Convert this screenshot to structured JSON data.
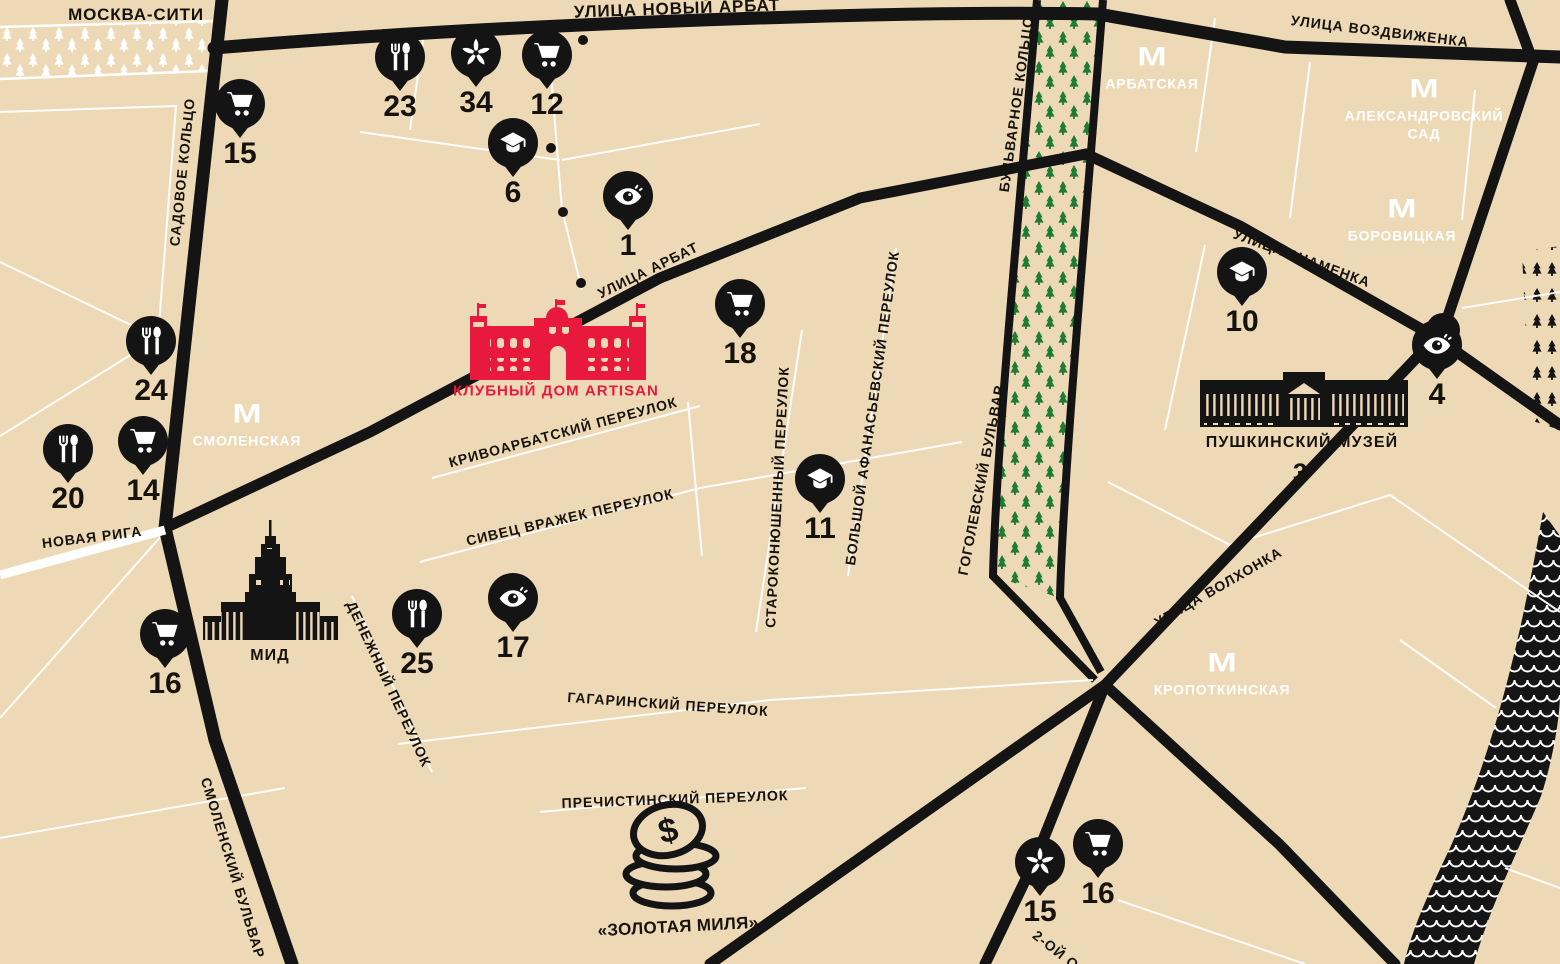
{
  "streets": {
    "moskva_city": "МОСКВА-СИТИ",
    "novy_arbat": "УЛИЦА НОВЫЙ АРБАТ",
    "vozdvizhenka": "УЛИЦА ВОЗДВИЖЕНКА",
    "sadovoe": "САДОВОЕ КОЛЬЦО",
    "bulvarnoe": "БУЛЬВАРНОЕ КОЛЬЦО",
    "arbat": "УЛИЦА АРБАТ",
    "znamenka": "УЛИЦА ЗНАМЕНКА",
    "krivoarbatsky": "КРИВОАРБАТСКИЙ ПЕРЕУЛОК",
    "sivtsev": "СИВЕЦ ВРАЖЕК ПЕРЕУЛОК",
    "starokonyushenny": "СТАРОКОНЮШЕННЫЙ ПЕРЕУЛОК",
    "afanasievsky": "БОЛЬШОЙ АФАНАСЬЕВСКИЙ ПЕРЕУЛОК",
    "gogolevsky": "ГОГОЛЕВСКИЙ БУЛЬВАР",
    "volkhonka": "УЛИЦА ВОЛХОНКА",
    "denezhny": "ДЕНЕЖНЫЙ ПЕРЕУЛОК",
    "novaya_riga": "НОВАЯ РИГА",
    "smolensky": "СМОЛЕНСКИЙ БУЛЬВАР",
    "gagarinsky": "ГАГАРИНСКИЙ ПЕРЕУЛОК",
    "prechistinsky": "ПРЕЧИСТИНСКИЙ ПЕРЕУЛОК",
    "obydensky_partial": "2-ОЙ О"
  },
  "landmarks": {
    "artisan": "КЛУБНЫЙ ДОМ ARTISAN",
    "mid": "МИД",
    "pushkin": "ПУШКИНСКИЙ МУЗЕЙ",
    "pushkin_number": "3",
    "golden_mile": "«ЗОЛОТАЯ МИЛЯ»"
  },
  "metro": {
    "logo": "М",
    "smolenskaya": "СМОЛЕНСКАЯ",
    "arbatskaya": "АРБАТСКАЯ",
    "alexandrovsky_line1": "АЛЕКСАНДРОВСКИЙ",
    "alexandrovsky_line2": "САД",
    "borovitskaya": "БОРОВИЦКАЯ",
    "kropotkinskaya": "КРОПОТКИНСКАЯ"
  },
  "markers": [
    {
      "icon": "cart",
      "number": "15"
    },
    {
      "icon": "restaurant",
      "number": "23"
    },
    {
      "icon": "flower",
      "number": "34"
    },
    {
      "icon": "cart",
      "number": "12"
    },
    {
      "icon": "education",
      "number": "6"
    },
    {
      "icon": "sight",
      "number": "1"
    },
    {
      "icon": "cart",
      "number": "18"
    },
    {
      "icon": "restaurant",
      "number": "24"
    },
    {
      "icon": "cart",
      "number": "14"
    },
    {
      "icon": "restaurant",
      "number": "20"
    },
    {
      "icon": "education",
      "number": "10"
    },
    {
      "icon": "sight",
      "number": "4"
    },
    {
      "icon": "education",
      "number": "11"
    },
    {
      "icon": "sight",
      "number": "17"
    },
    {
      "icon": "restaurant",
      "number": "25"
    },
    {
      "icon": "cart",
      "number": "16"
    },
    {
      "icon": "flower",
      "number": "15"
    },
    {
      "icon": "cart",
      "number": "16"
    }
  ],
  "colors": {
    "background": "#eed9b6",
    "road": "#141414",
    "accent_red": "#e8193c",
    "tree_green": "#1e7b33",
    "white": "#ffffff"
  }
}
